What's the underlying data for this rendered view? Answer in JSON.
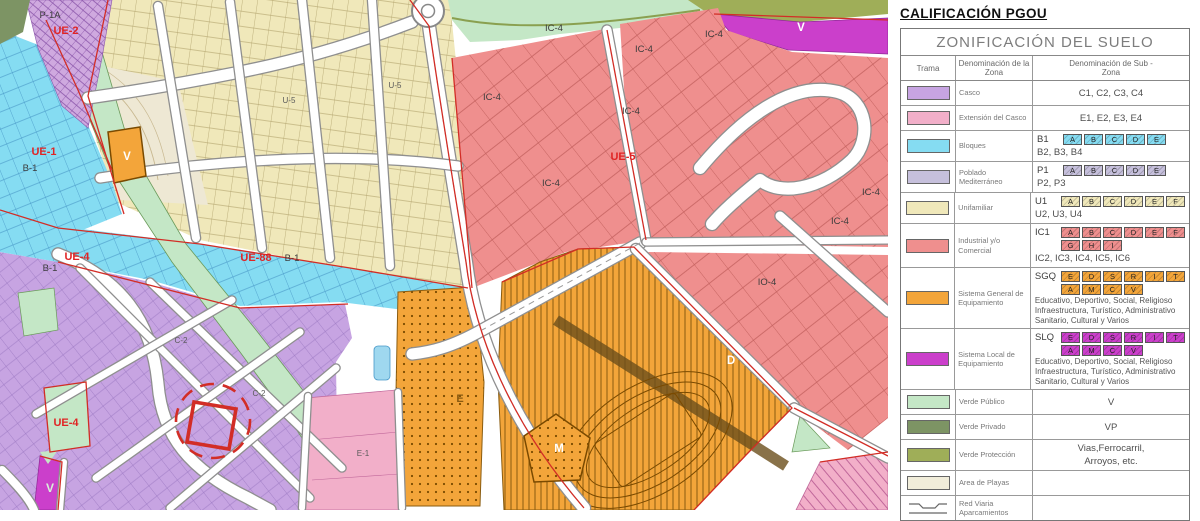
{
  "colors": {
    "casco": "#c7a4e2",
    "extension": "#f2afc9",
    "bloques": "#85dcf2",
    "poblado": "#c6c0dc",
    "unifamiliar": "#f0e8ba",
    "industrial": "#ef8f8e",
    "sgq": "#f3a53a",
    "slq": "#cb3fcb",
    "verde_publico": "#c4e7c6",
    "verde_privado": "#7d9464",
    "verde_proteccion": "#9fae58",
    "playas": "#f1edda",
    "red_line": "#d22d26",
    "street": "#ffffff",
    "street_casing": "#8f8f8f"
  },
  "legend": {
    "heading": "CALIFICACIÓN PGOU",
    "table_title": "ZONIFICACIÓN DEL SUELO",
    "columns": [
      "Trama",
      "Denominación de la Zona",
      "Denominación de Sub -Zona"
    ],
    "rows": [
      {
        "id": "casco",
        "color_key": "casco",
        "zone": "Casco",
        "lines": [
          {
            "text": "C1, C2, C3, C4",
            "center": true
          }
        ]
      },
      {
        "id": "extension",
        "color_key": "extension",
        "zone": "Extensión del Casco",
        "lines": [
          {
            "text": "E1, E2, E3, E4",
            "center": true
          }
        ]
      },
      {
        "id": "bloques",
        "color_key": "bloques",
        "zone": "Bloques",
        "lines": [
          {
            "prefix": "B1",
            "chips": [
              "A",
              "B",
              "C",
              "D",
              "E"
            ]
          },
          {
            "text": "B2, B3, B4"
          }
        ]
      },
      {
        "id": "poblado",
        "color_key": "poblado",
        "zone": "Poblado Mediterráneo",
        "lines": [
          {
            "prefix": "P1",
            "chips": [
              "A",
              "B",
              "C",
              "D",
              "E"
            ]
          },
          {
            "text": "P2, P3"
          }
        ]
      },
      {
        "id": "unifamiliar",
        "color_key": "unifamiliar",
        "zone": "Unifamiliar",
        "lines": [
          {
            "prefix": "U1",
            "chips": [
              "A",
              "B",
              "C",
              "D",
              "E",
              "F"
            ]
          },
          {
            "text": "U2, U3, U4"
          }
        ]
      },
      {
        "id": "industrial",
        "color_key": "industrial",
        "zone": "Industrial y/o Comercial",
        "lines": [
          {
            "prefix": "IC1",
            "chips": [
              "A",
              "B",
              "C",
              "D",
              "E",
              "F"
            ]
          },
          {
            "chips": [
              "G",
              "H",
              "I"
            ],
            "indent": true
          },
          {
            "text": "IC2, IC3, IC4, IC5, IC6"
          }
        ]
      },
      {
        "id": "sgq",
        "color_key": "sgq",
        "zone": "Sistema General de Equipamiento",
        "lines": [
          {
            "prefix": "SGQ",
            "chips": [
              "E",
              "D",
              "S",
              "R",
              "I",
              "T"
            ]
          },
          {
            "chips": [
              "A",
              "M",
              "C",
              "V"
            ],
            "indent": true
          },
          {
            "note": "Educativo, Deportivo, Social, Religioso"
          },
          {
            "note": "Infraestructura, Turístico, Administrativo"
          },
          {
            "note": "Sanitario, Cultural y Varios"
          }
        ]
      },
      {
        "id": "slq",
        "color_key": "slq",
        "zone": "Sistema Local de Equipamiento",
        "lines": [
          {
            "prefix": "SLQ",
            "chips": [
              "E",
              "D",
              "S",
              "R",
              "I",
              "T"
            ]
          },
          {
            "chips": [
              "A",
              "M",
              "C",
              "V"
            ],
            "indent": true
          },
          {
            "note": "Educativo, Deportivo, Social, Religioso"
          },
          {
            "note": "Infraestructura, Turístico, Administrativo"
          },
          {
            "note": "Sanitario, Cultural y Varios"
          }
        ]
      },
      {
        "id": "verde_publico",
        "color_key": "verde_publico",
        "zone": "Verde Público",
        "lines": [
          {
            "text": "V",
            "center": true
          }
        ]
      },
      {
        "id": "verde_privado",
        "color_key": "verde_privado",
        "zone": "Verde Privado",
        "lines": [
          {
            "text": "VP",
            "center": true
          }
        ]
      },
      {
        "id": "verde_proteccion",
        "color_key": "verde_proteccion",
        "zone": "Verde Protección",
        "lines": [
          {
            "text": "Vias,Ferrocarril,",
            "center": true
          },
          {
            "text": "Arroyos, etc.",
            "center": true
          }
        ]
      },
      {
        "id": "playas",
        "color_key": "playas",
        "zone": "Area de Playas",
        "lines": []
      },
      {
        "id": "red_viaria",
        "color_key": null,
        "zone": "Red Viaria Aparcamientos",
        "lines": [],
        "swatch_symbol": "road-profile"
      }
    ]
  },
  "map": {
    "labels": [
      {
        "text": "P-1A",
        "x": 50,
        "y": 18,
        "k": "blk"
      },
      {
        "text": "UE-2",
        "x": 66,
        "y": 34,
        "k": "red"
      },
      {
        "text": "UE-1",
        "x": 44,
        "y": 155,
        "k": "red"
      },
      {
        "text": "B-1",
        "x": 30,
        "y": 171,
        "k": "blk"
      },
      {
        "text": "B-1",
        "x": 50,
        "y": 271,
        "k": "blk"
      },
      {
        "text": "UE-4",
        "x": 77,
        "y": 260,
        "k": "red"
      },
      {
        "text": "UE-88",
        "x": 256,
        "y": 261,
        "k": "red"
      },
      {
        "text": "B-1",
        "x": 292,
        "y": 261,
        "k": "blk"
      },
      {
        "text": "UE-4",
        "x": 66,
        "y": 426,
        "k": "red"
      },
      {
        "text": "C-2",
        "x": 181,
        "y": 343,
        "k": "sm"
      },
      {
        "text": "C-2",
        "x": 259,
        "y": 396,
        "k": "sm"
      },
      {
        "text": "E-1",
        "x": 363,
        "y": 456,
        "k": "sm"
      },
      {
        "text": "U-5",
        "x": 395,
        "y": 88,
        "k": "sm"
      },
      {
        "text": "U-5",
        "x": 289,
        "y": 103,
        "k": "sm"
      },
      {
        "text": "V",
        "x": 127,
        "y": 160,
        "k": "wht"
      },
      {
        "text": "V",
        "x": 801,
        "y": 31,
        "k": "wht"
      },
      {
        "text": "V",
        "x": 50,
        "y": 492,
        "k": "grn"
      },
      {
        "text": "D",
        "x": 731,
        "y": 364,
        "k": "wht"
      },
      {
        "text": "M",
        "x": 559,
        "y": 452,
        "k": "wht"
      },
      {
        "text": "E",
        "x": 460,
        "y": 402,
        "k": "or"
      },
      {
        "text": "IC-4",
        "x": 554,
        "y": 31,
        "k": "blk"
      },
      {
        "text": "IC-4",
        "x": 644,
        "y": 52,
        "k": "blk"
      },
      {
        "text": "IC-4",
        "x": 714,
        "y": 37,
        "k": "blk"
      },
      {
        "text": "IC-4",
        "x": 492,
        "y": 100,
        "k": "blk"
      },
      {
        "text": "IC-4",
        "x": 631,
        "y": 114,
        "k": "blk"
      },
      {
        "text": "IC-4",
        "x": 551,
        "y": 186,
        "k": "blk"
      },
      {
        "text": "IC-4",
        "x": 871,
        "y": 195,
        "k": "blk"
      },
      {
        "text": "IC-4",
        "x": 840,
        "y": 224,
        "k": "blk"
      },
      {
        "text": "UE-5",
        "x": 623,
        "y": 160,
        "k": "red"
      },
      {
        "text": "IO-4",
        "x": 767,
        "y": 285,
        "k": "blk"
      }
    ]
  }
}
